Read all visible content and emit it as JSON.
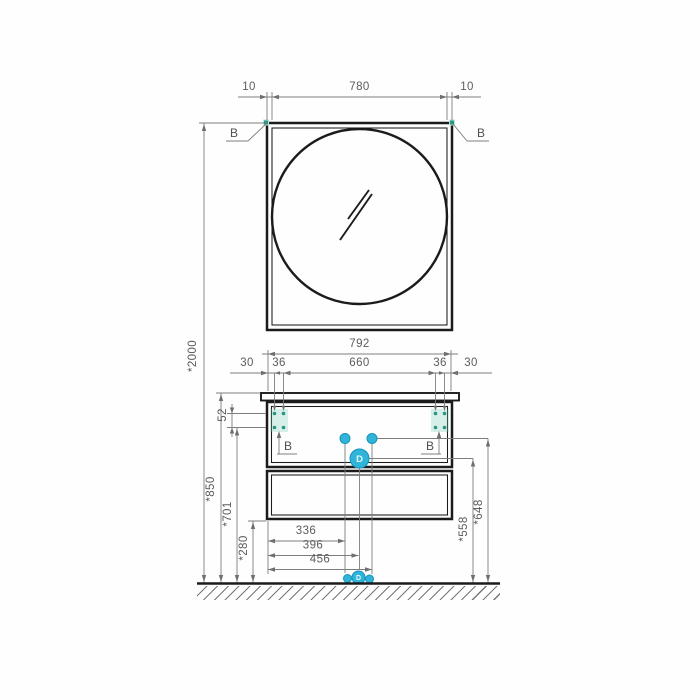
{
  "drawing": {
    "mirror": {
      "dim_left": "10",
      "dim_width": "780",
      "dim_right": "10",
      "corner_left": "B",
      "corner_right": "B"
    },
    "cabinet": {
      "dim_width": "792",
      "dim_segments": [
        "30",
        "36",
        "660",
        "36",
        "30"
      ],
      "hole_left": "B",
      "hole_right": "B",
      "drain": "D",
      "floor_drain": "D"
    },
    "left": {
      "total": "*2000",
      "counter": "*850",
      "mount": "*701",
      "clearance": "*280",
      "spacing": "52"
    },
    "right": {
      "drain": "*558",
      "supply": "*648"
    },
    "bottom": [
      "336",
      "396",
      "456"
    ],
    "colors": {
      "accent_cyan": "#30b4da",
      "marker_teal": "#2a9486",
      "outline": "#1b1b1b",
      "dimension_gray": "#7d7d7d"
    }
  }
}
